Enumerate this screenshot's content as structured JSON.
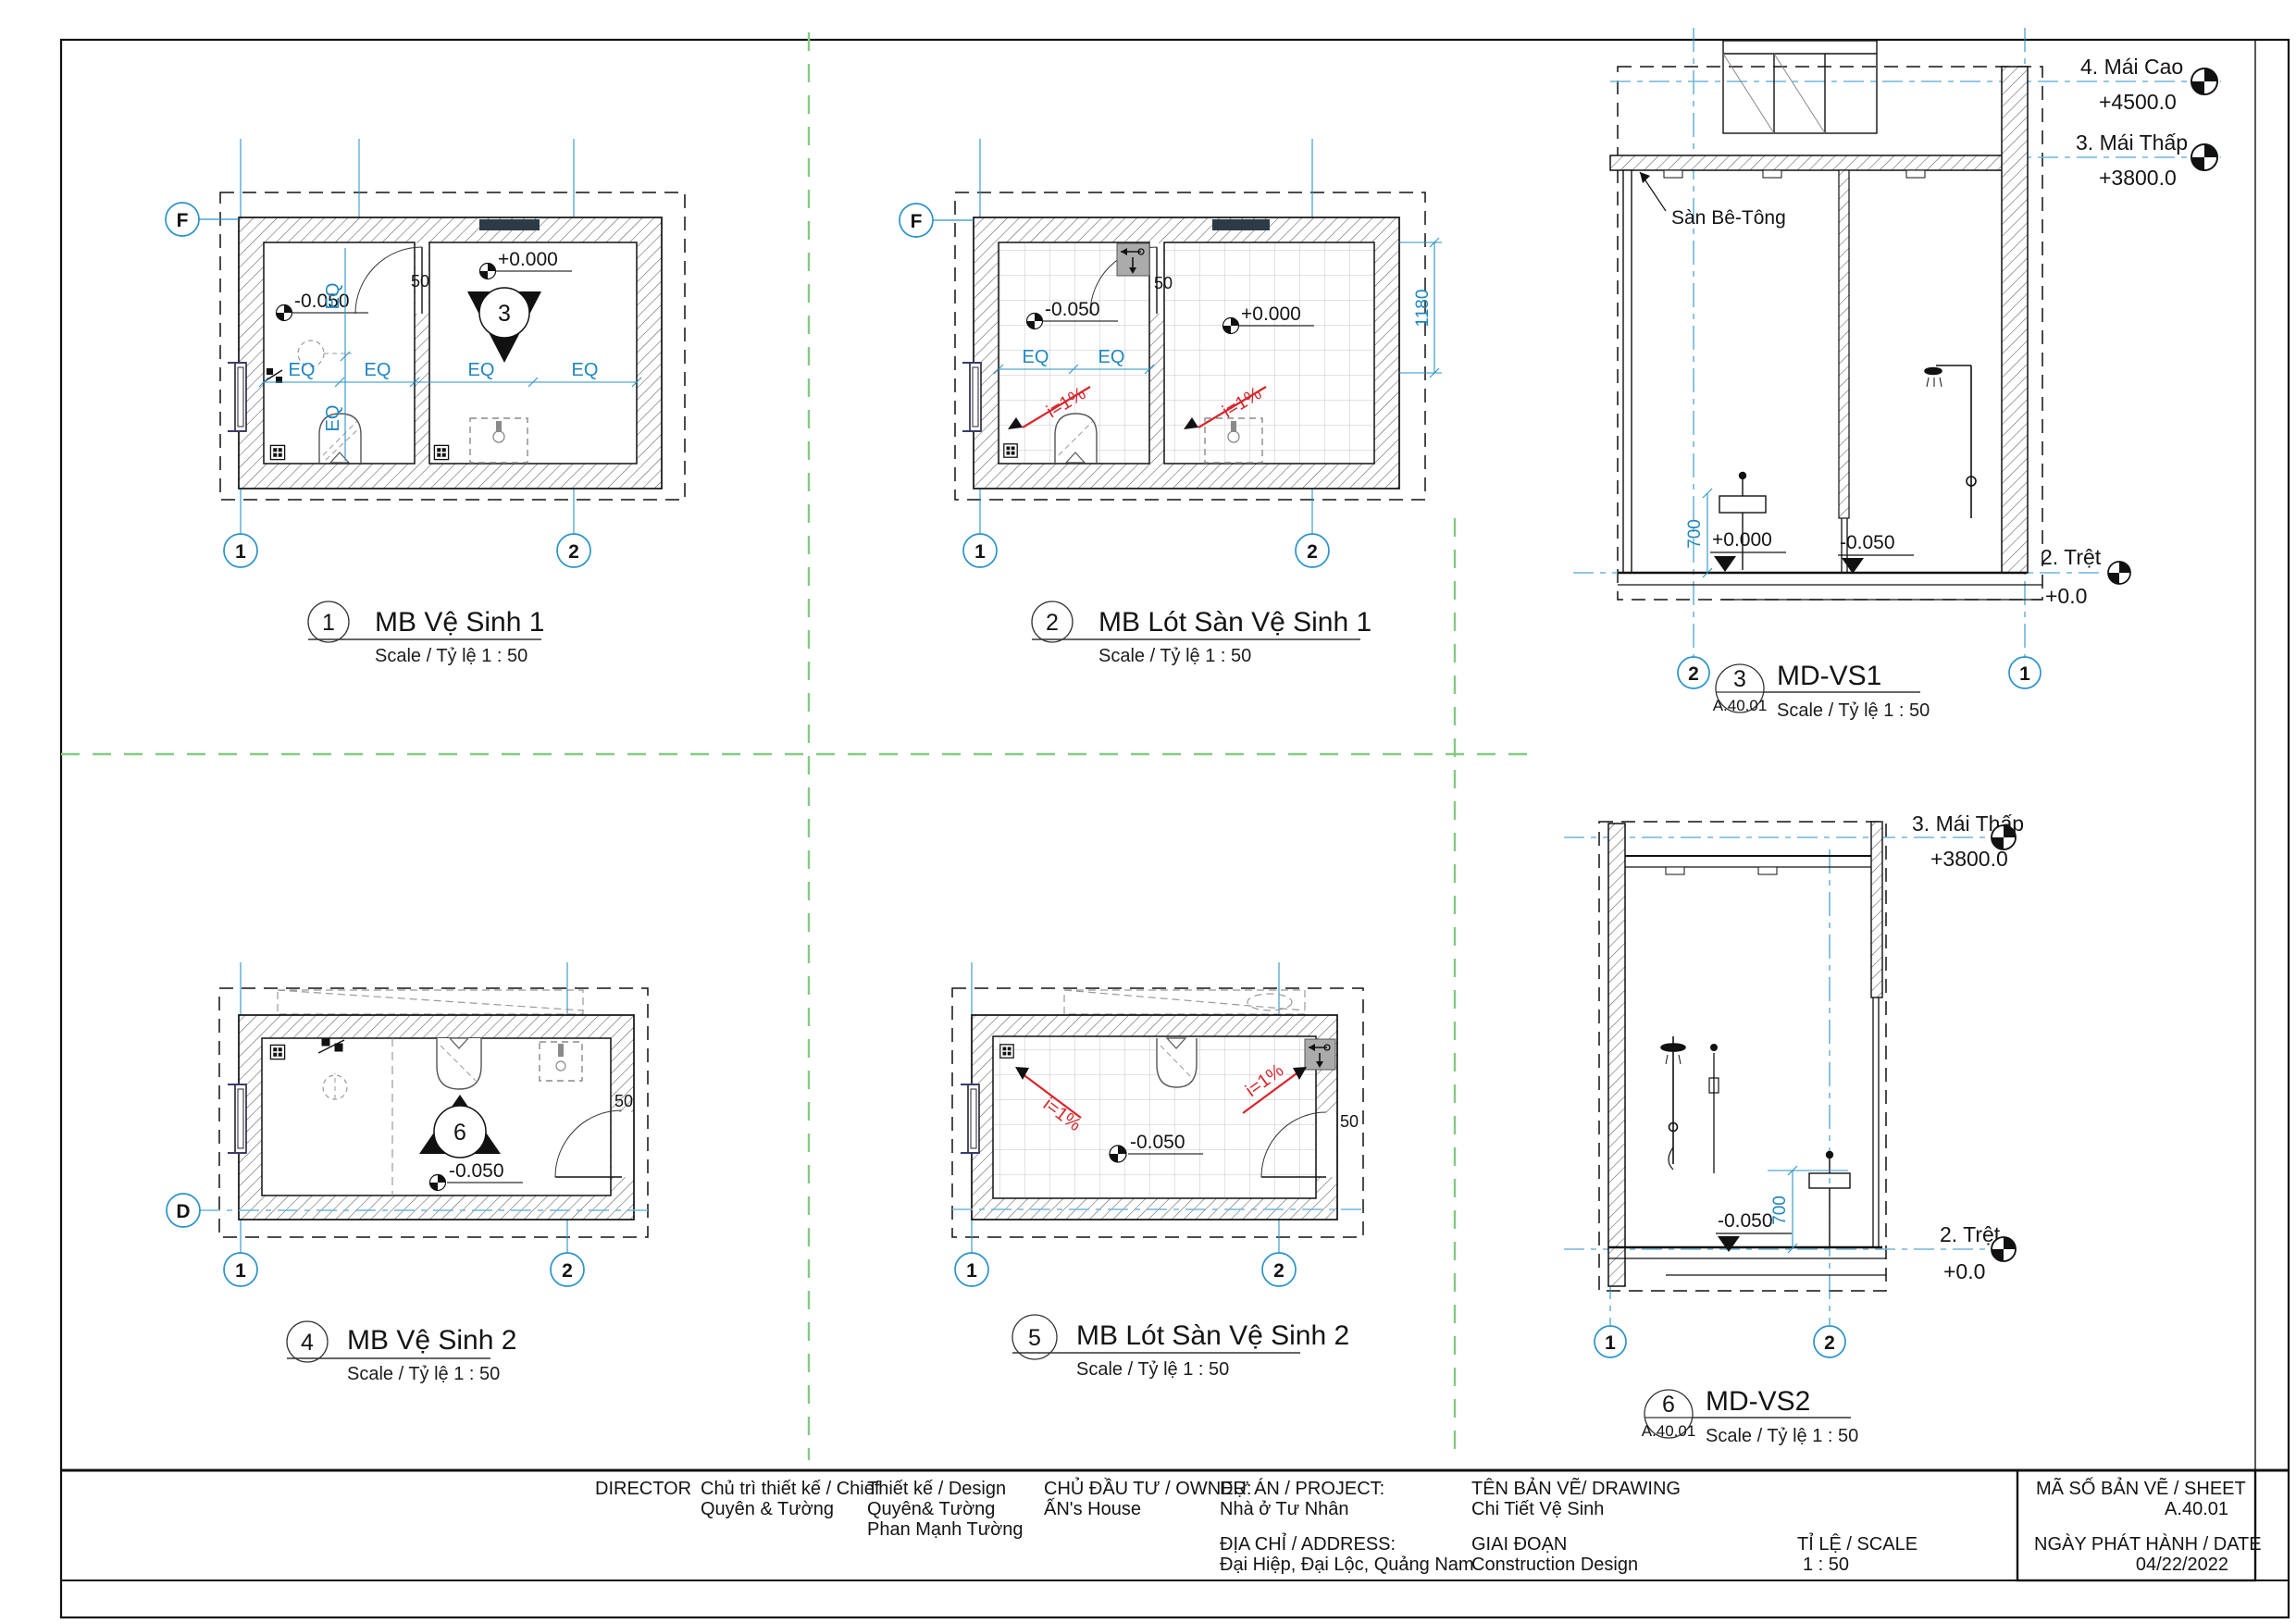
{
  "colors": {
    "accent_blue": "#2a93c9",
    "light_blue_dash": "#6fb6de",
    "divider_green": "#85ca85",
    "slope_red": "#d8262c",
    "linework": "#141414"
  },
  "views": {
    "plan1": {
      "num": "1",
      "title": "MB Vệ Sinh 1",
      "scale": "Scale / Tỷ lệ   1 : 50",
      "row": "F",
      "c1": "1",
      "c2": "2",
      "eq": "EQ",
      "d50": "50",
      "neg": "-0.050",
      "zero": "+0.000",
      "cut": "3"
    },
    "plan2": {
      "num": "2",
      "title": "MB Lót Sàn Vệ Sinh 1",
      "scale": "Scale / Tỷ lệ   1 : 50",
      "row": "F",
      "c1": "1",
      "c2": "2",
      "eq": "EQ",
      "d50": "50",
      "d1180": "1180",
      "neg": "-0.050",
      "zero": "+0.000",
      "slope": "i=1%"
    },
    "sec1": {
      "num": "3",
      "ref": "A.40.01",
      "title": "MD-VS1",
      "scale": "Scale / Tỷ lệ   1 : 50",
      "b_left": "2",
      "b_right": "1",
      "l1": "4. Mái Cao",
      "e1": "+4500.0",
      "l2": "3. Mái Thấp",
      "e2": "+3800.0",
      "l3": "2. Trệt",
      "e3": "+0.0",
      "note": "Sàn Bê-Tông",
      "d700": "700",
      "zero": "+0.000",
      "neg": "-0.050"
    },
    "plan4": {
      "num": "4",
      "title": "MB Vệ Sinh 2",
      "scale": "Scale / Tỷ lệ   1 : 50",
      "row": "D",
      "c1": "1",
      "c2": "2",
      "neg": "-0.050",
      "d50": "50",
      "cut": "6"
    },
    "plan5": {
      "num": "5",
      "title": "MB Lót Sàn Vệ Sinh 2",
      "scale": "Scale / Tỷ lệ   1 : 50",
      "c1": "1",
      "c2": "2",
      "neg": "-0.050",
      "d50": "50",
      "slope": "i=1%"
    },
    "sec2": {
      "num": "6",
      "ref": "A.40.01",
      "title": "MD-VS2",
      "scale": "Scale / Tỷ lệ   1 : 50",
      "b_left": "1",
      "b_right": "2",
      "l1": "3. Mái Thấp",
      "e1": "+3800.0",
      "l2": "2. Trệt",
      "e2": "+0.0",
      "d700": "700",
      "neg": "-0.050"
    }
  },
  "titleblock": {
    "director": "DIRECTOR",
    "chief_label": "Chủ trì thiết kế / Chief",
    "chief_name": "Quyên & Tường",
    "design_label": "Thiết kế / Design",
    "design_name1": "Quyên& Tường",
    "design_name2": "Phan Mạnh Tường",
    "owner_label": "CHỦ ĐẦU TƯ / OWNER:",
    "owner_name": "ẤN's House",
    "project_label": "DỰ ÁN / PROJECT:",
    "project_name": "Nhà ở Tư Nhân",
    "address_label": "ĐỊA CHỈ / ADDRESS:",
    "address_value": "Đại Hiệp, Đại Lộc, Quảng Nam",
    "drawing_label": "TÊN BẢN VẼ/ DRAWING",
    "drawing_name": "Chi Tiết Vệ Sinh",
    "phase_label": "GIAI ĐOẠN",
    "phase_value": "Construction Design",
    "scale_label": "TỈ LỆ / SCALE",
    "scale_value": "1 : 50",
    "sheet_label": "MÃ SỐ BẢN VẼ / SHEET",
    "sheet_value": "A.40.01",
    "date_label": "NGÀY PHÁT HÀNH / DATE",
    "date_value": "04/22/2022"
  }
}
